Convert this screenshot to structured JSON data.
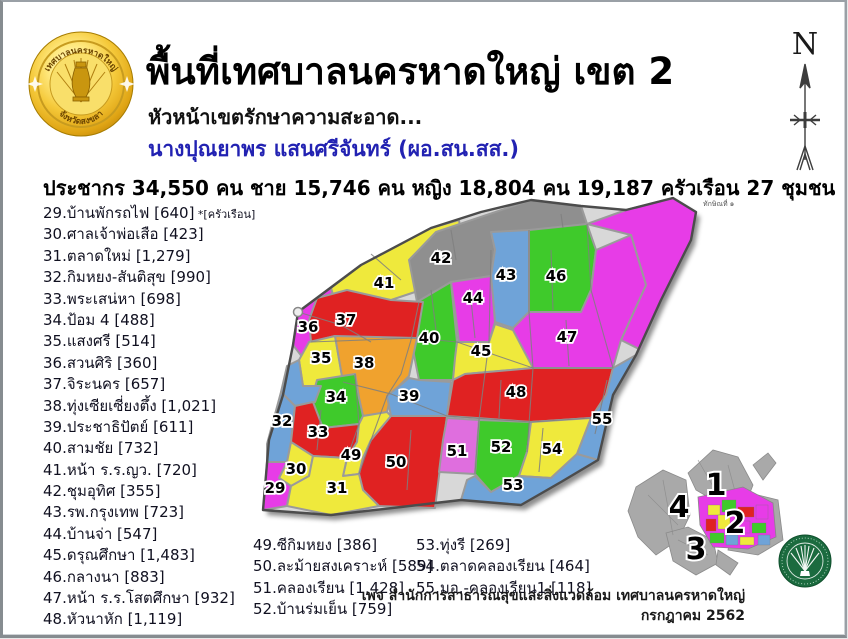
{
  "header": {
    "title": "พื้นที่เทศบาลนครหาดใหญ่ เขต 2",
    "dept_line": "หัวหน้าเขตรักษาความสะอาด...",
    "officer": "นางปุณยาพร  แสนศรีจันทร์ (ผอ.สน.สส.)"
  },
  "stats": {
    "line": "ประชากร 34,550 คน ชาย 15,746 คน หญิง 18,804 คน 19,187 ครัวเรือน 27 ชุมชน"
  },
  "logo": {
    "top_text": "เทศบาลนครหาดใหญ่",
    "bottom_text": "จังหวัดสงขลา"
  },
  "compass": {
    "label": "N"
  },
  "communities": {
    "unit_note": "*[ครัวเรือน]",
    "col1": [
      {
        "no": "29",
        "name": "บ้านพักรถไฟ",
        "count": "640",
        "note": "*[ครัวเรือน]"
      },
      {
        "no": "30",
        "name": "ศาลเจ้าพ่อเสือ",
        "count": "423"
      },
      {
        "no": "31",
        "name": "ตลาดใหม่",
        "count": "1,279"
      },
      {
        "no": "32",
        "name": "กิมหยง-สันติสุข",
        "count": "990"
      },
      {
        "no": "33",
        "name": "พระเสน่หา",
        "count": "698"
      },
      {
        "no": "34",
        "name": "ป้อม 4",
        "count": "488"
      },
      {
        "no": "35",
        "name": "แสงศรี",
        "count": "514"
      },
      {
        "no": "36",
        "name": "สวนศิริ",
        "count": "360"
      },
      {
        "no": "37",
        "name": "จิระนคร",
        "count": "657"
      },
      {
        "no": "38",
        "name": "ทุ่งเซียเซี่ยงตึ้ง",
        "count": "1,021"
      },
      {
        "no": "39",
        "name": "ประชาธิปัตย์",
        "count": "611"
      },
      {
        "no": "40",
        "name": "สามชัย",
        "count": "732"
      },
      {
        "no": "41",
        "name": "หน้า ร.ร.ญว.",
        "count": "720"
      },
      {
        "no": "42",
        "name": "ชุมอุทิศ",
        "count": "355"
      },
      {
        "no": "43",
        "name": "รพ.กรุงเทพ",
        "count": "723"
      },
      {
        "no": "44",
        "name": "บ้านจ่า",
        "count": "547"
      },
      {
        "no": "45",
        "name": "ดรุณศึกษา",
        "count": "1,483"
      },
      {
        "no": "46",
        "name": "กลางนา",
        "count": "883"
      },
      {
        "no": "47",
        "name": "หน้า ร.ร.โสตศึกษา",
        "count": "932"
      },
      {
        "no": "48",
        "name": "หัวนาหัก",
        "count": "1,119"
      }
    ],
    "col2": [
      {
        "no": "49",
        "name": "ซีกิมหยง",
        "count": "386"
      },
      {
        "no": "50",
        "name": "ละม้ายสงเคราะห์",
        "count": "589"
      },
      {
        "no": "51",
        "name": "คลองเรียน",
        "count": "1,428"
      },
      {
        "no": "52",
        "name": "บ้านร่มเย็น",
        "count": "759"
      }
    ],
    "col3": [
      {
        "no": "53",
        "name": "ทุ่งรี",
        "count": "269"
      },
      {
        "no": "54",
        "name": "ตลาดคลองเรียน",
        "count": "464"
      },
      {
        "no": "55",
        "name": "มอ.-คลองเรียน1",
        "count": "118"
      }
    ]
  },
  "map": {
    "road_label": "ทักษิณที่ ๑",
    "palette": {
      "magenta": "#e73ce7",
      "yellow": "#efe93c",
      "red": "#e02222",
      "green": "#3fca2b",
      "blue": "#6fa3d8",
      "orange": "#f0a22e",
      "gray": "#8f8f8f",
      "violet": "#df6ede"
    },
    "outline": "47,122 110,75 180,38 230,22 280,10 330,16 375,20 422,8 445,22 440,50 410,110 385,165 362,205 347,270 310,292 270,315 210,310 150,317 80,325 12,320 18,250 32,205 42,155",
    "regions": [
      {
        "no": "41",
        "color": "yellow",
        "points": "80,98 110,75 180,38 208,30 214,72 185,95 140,110 90,135",
        "lx": 133,
        "ly": 98
      },
      {
        "no": "42",
        "color": "gray",
        "points": "185,42 280,10 330,16 336,34 284,42 244,60 240,86 200,92 166,112 158,70",
        "lx": 190,
        "ly": 73
      },
      {
        "no": "",
        "color": "magenta",
        "points": "336,34 375,20 422,8 445,22 440,50 410,110 390,160 370,150 395,95 380,45"
      },
      {
        "no": "43",
        "color": "blue",
        "points": "240,42 278,40 278,122 262,138 244,132 240,86 244,60",
        "lx": 255,
        "ly": 90
      },
      {
        "no": "46",
        "color": "green",
        "points": "278,40 336,34 345,60 340,100 330,122 278,122",
        "lx": 305,
        "ly": 91
      },
      {
        "no": "47",
        "color": "magenta",
        "points": "262,138 278,122 330,122 340,100 345,60 380,45 395,95 370,150 362,178 282,178 264,160",
        "lx": 316,
        "ly": 152
      },
      {
        "no": "44",
        "color": "magenta",
        "points": "200,92 240,86 244,132 238,152 208,152 204,120",
        "lx": 222,
        "ly": 113
      },
      {
        "no": "40",
        "color": "green",
        "points": "166,112 200,92 206,152 202,190 168,190 160,150",
        "lx": 178,
        "ly": 153
      },
      {
        "no": "36",
        "color": "magenta",
        "points": "42,155 47,122 80,98 90,135 68,160 52,168",
        "lx": 57,
        "ly": 142
      },
      {
        "no": "37",
        "color": "red",
        "points": "58,130 66,108 96,100 140,110 172,112 166,148 120,152 84,146 60,152",
        "lx": 95,
        "ly": 135
      },
      {
        "no": "35",
        "color": "yellow",
        "points": "48,170 58,152 84,146 92,192 70,196 52,196",
        "lx": 70,
        "ly": 173
      },
      {
        "no": "38",
        "color": "orange",
        "points": "84,146 166,148 158,186 140,204 136,222 112,226 108,208 104,184 92,192",
        "lx": 113,
        "ly": 178
      },
      {
        "no": "39",
        "color": "blue",
        "points": "136,206 158,188 168,190 200,192 196,226 140,226",
        "lx": 158,
        "ly": 211
      },
      {
        "no": "34",
        "color": "green",
        "points": "66,190 104,184 108,208 112,226 108,234 72,238 60,212",
        "lx": 85,
        "ly": 212
      },
      {
        "no": "45",
        "color": "yellow",
        "points": "206,152 238,152 244,134 262,140 282,178 214,184 202,190 204,168",
        "lx": 230,
        "ly": 166
      },
      {
        "no": "48",
        "color": "red",
        "points": "202,190 214,184 282,178 362,178 355,205 340,228 280,232 226,228 196,226",
        "lx": 265,
        "ly": 207
      },
      {
        "no": "",
        "color": "blue",
        "points": "36,176 48,170 52,196 70,196 64,212 44,216 30,202"
      },
      {
        "no": "32",
        "color": "blue",
        "points": "16,254 30,202 44,216 40,252 36,272 16,272",
        "lx": 31,
        "ly": 236
      },
      {
        "no": "33",
        "color": "red",
        "points": "44,216 62,212 72,238 108,234 106,252 96,268 62,266 40,252",
        "lx": 67,
        "ly": 247
      },
      {
        "no": "49",
        "color": "yellow",
        "points": "96,268 106,252 108,234 112,226 136,222 140,226 120,250 112,268 108,284 92,286",
        "lx": 100,
        "ly": 270
      },
      {
        "no": "50",
        "color": "red",
        "points": "112,268 120,250 140,226 196,226 190,270 184,318 128,316 112,300 108,284",
        "lx": 145,
        "ly": 277
      },
      {
        "no": "51",
        "color": "violet",
        "points": "196,228 228,230 224,284 188,282 192,250",
        "lx": 206,
        "ly": 266
      },
      {
        "no": "52",
        "color": "green",
        "points": "228,230 280,232 276,262 268,286 240,302 224,284",
        "lx": 250,
        "ly": 262
      },
      {
        "no": "54",
        "color": "yellow",
        "points": "280,232 340,228 326,264 300,288 268,286 276,262",
        "lx": 301,
        "ly": 264
      },
      {
        "no": "55",
        "color": "blue",
        "points": "362,178 385,165 362,205 347,270 326,264 340,228 355,205",
        "lx": 351,
        "ly": 234
      },
      {
        "no": "53",
        "color": "blue",
        "points": "216,290 224,286 240,302 268,286 300,288 326,264 347,270 310,292 270,315 210,310",
        "lx": 262,
        "ly": 300
      },
      {
        "no": "30",
        "color": "yellow",
        "points": "40,252 62,266 58,286 40,296 28,288 36,272",
        "lx": 45,
        "ly": 284
      },
      {
        "no": "29",
        "color": "magenta",
        "points": "16,272 36,272 28,288 40,296 36,316 12,320 14,300",
        "lx": 24,
        "ly": 303
      },
      {
        "no": "31",
        "color": "yellow",
        "points": "62,266 96,268 92,286 108,284 112,300 128,316 80,325 36,316 40,296 58,286",
        "lx": 86,
        "ly": 303
      }
    ]
  },
  "minimap": {
    "highlight_zone": "2",
    "zones": [
      {
        "no": "1",
        "x": 98,
        "y": 50
      },
      {
        "no": "2",
        "x": 117,
        "y": 88
      },
      {
        "no": "3",
        "x": 78,
        "y": 114
      },
      {
        "no": "4",
        "x": 61,
        "y": 72
      }
    ]
  },
  "credit": {
    "line1": "เพจ สำนักการสาธารณสุขและสิ่งแวดล้อม เทศบาลนครหาดใหญ่",
    "line2": "กรกฎาคม 2562"
  }
}
